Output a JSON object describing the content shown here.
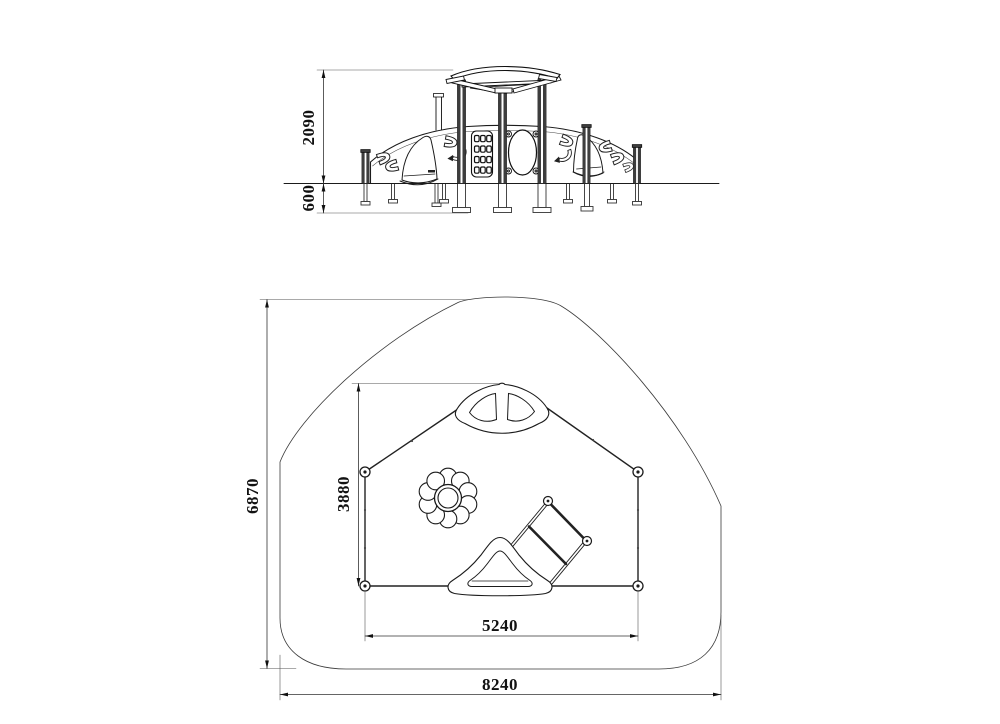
{
  "drawing": {
    "type": "playground equipment technical drawing",
    "elevation": {
      "dim_height": "2090",
      "dim_depth": "600"
    },
    "plan": {
      "dim_zone_length": "6870",
      "dim_inner_depth": "3880",
      "dim_inner_width": "5240",
      "dim_zone_width": "8240"
    },
    "colors": {
      "line": "#1b1b1b",
      "background": "#ffffff",
      "post_fill": "#3d3d3d"
    }
  }
}
